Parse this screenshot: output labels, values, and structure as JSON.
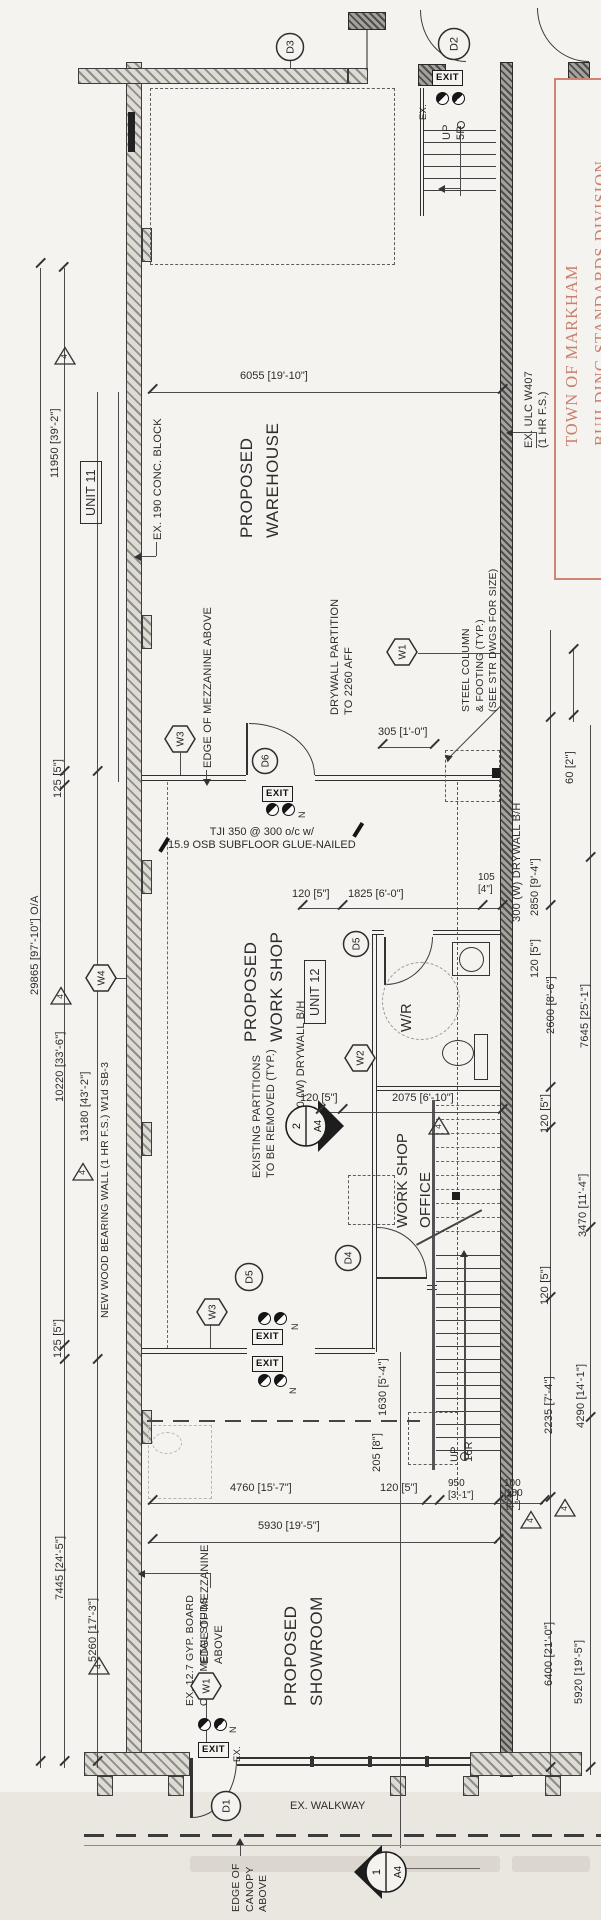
{
  "colors": {
    "stamp_red": "#cf8474",
    "paper": "#f5f3ef",
    "ink": "#2e2e2e"
  },
  "stamp": {
    "text": "TOWN OF MARKHAM\nBUILDING STANDARDS DIVISION"
  },
  "units": {
    "unit11": "UNIT 11",
    "unit12": "UNIT 12"
  },
  "rooms": {
    "warehouse": "PROPOSED\nWAREHOUSE",
    "workshop": "PROPOSED\nWORK SHOP",
    "office": "WORK SHOP\nOFFICE",
    "washroom": "W/R",
    "showroom": "PROPOSED\nSHOWROOM"
  },
  "notes": {
    "conc_block": "EX. 190 CONC. BLOCK",
    "mezz_above_1": "EDGE OF MEZZANINE ABOVE",
    "mezz_above_2": "EDGE OF MEZZANINE\nABOVE",
    "drywall_partition": "DRYWALL PARTITION\nTO 2260 AFF",
    "steel_column": "STEEL COLUMN\n& FOOTING (TYP.)\n(SEE STR DWGS FOR SIZE)",
    "ulc": "EX. ULC W407\n(1 HR F.S.)",
    "tji": "TJI 350 @ 300 o/c w/\n15.9 OSB SUBFLOOR GLUE-NAILED",
    "existing_partitions": "EXISTING PARTITIONS\nTO BE REMOVED (TYP.)",
    "drywall_bh_700": "700 (W) DRYWALL B/H",
    "drywall_bh_300": "300 (W) DRYWALL B/H",
    "bearing_wall": "NEW WOOD BEARING WALL (1 HR F.S.) W1d SB-3",
    "gyp_board": "EX. 12.7 GYP. BOARD\nON 92 METAL STUDS",
    "canopy": "EDGE OF\nCANOPY\nABOVE",
    "walkway": "EX. WALKWAY",
    "up5r": "UP\n5R",
    "up16r": "UP\n16R",
    "exit": "EXIT",
    "ex": "EX.",
    "north": "N"
  },
  "dims": {
    "oa": "29865 [97'-10\"] O/A",
    "d11950": "11950 [39'-2\"]",
    "d125": "125 [5\"]",
    "d10220": "10220 [33'-6\"]",
    "d13180": "13180 [43'-2\"]",
    "d7445": "7445 [24'-5\"]",
    "d5260": "5260 [17'-3\"]",
    "d6055": "6055 [19'-10\"]",
    "d305": "305 [1'-0\"]",
    "d60": "60 [2\"]",
    "d120": "120 [5\"]",
    "d1825": "1825 [6'-0\"]",
    "d105": "105\n[4\"]",
    "d2850": "2850 [9'-4\"]",
    "d7645": "7645 [25'-1\"]",
    "d2600": "2600 [8'-6\"]",
    "d3470": "3470 [11'-4\"]",
    "d4290": "4290 [14'-1\"]",
    "d2235": "2235 [7'-4\"]",
    "d6400": "6400 [21'-0\"]",
    "d5920": "5920 [19'-5\"]",
    "d2075": "2075 [6'-10\"]",
    "d1630": "1630 [5'-4\"]",
    "d205": "205 [8\"]",
    "d4760": "4760 [15'-7\"]",
    "d5930": "5930 [19'-5\"]",
    "d950": "950\n[3'-1\"]",
    "d100": "100\n[4\"]"
  },
  "markers": {
    "d1": "D1",
    "d2": "D2",
    "d3": "D3",
    "d4": "D4",
    "d5": "D5",
    "d6": "D6",
    "w1": "W1",
    "w2": "W2",
    "w3": "W3",
    "w4": "W4",
    "rev": "4",
    "section1_num": "1",
    "section2_num": "2",
    "section_sheet": "A4"
  }
}
